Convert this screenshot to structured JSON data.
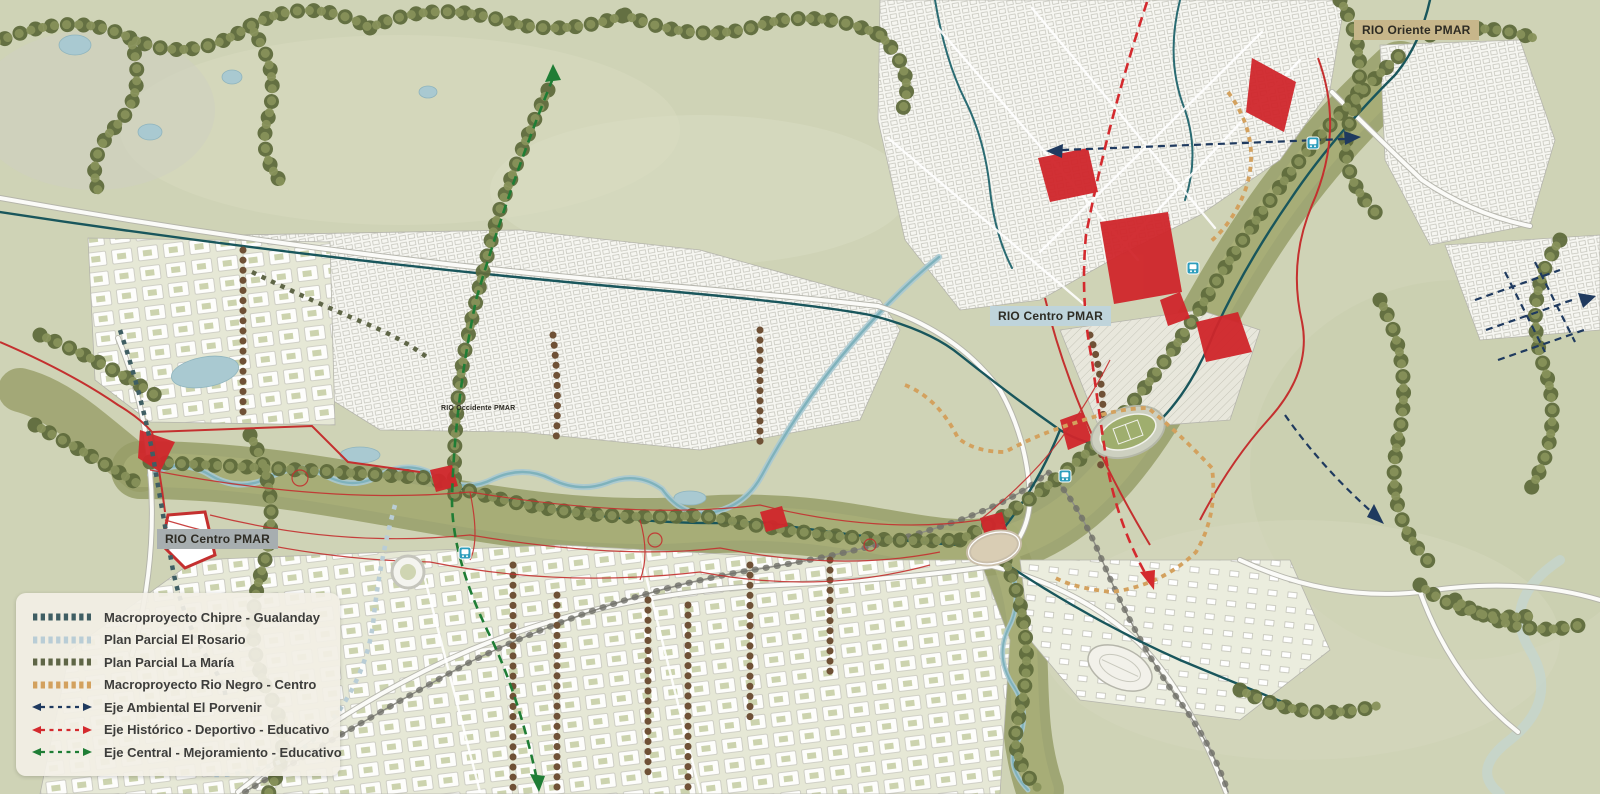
{
  "map": {
    "labels": [
      {
        "id": "rio-oriente",
        "text": "RIO Oriente PMAR",
        "bg": "#c7b68a"
      },
      {
        "id": "rio-centro-east",
        "text": "RIO Centro PMAR",
        "bg": "#bfd4db"
      },
      {
        "id": "rio-centro-west",
        "text": "RIO Centro PMAR",
        "bg": "#a7aeb0"
      },
      {
        "id": "rio-occidente",
        "text": "RIO Occidente PMAR",
        "bg": "transparent"
      }
    ],
    "station_icon": "bus-station",
    "colors": {
      "terrain": "#cfd3b6",
      "forest": "#64713f",
      "wetland": "#8f9560",
      "water": "#a9c9d1",
      "river_line": "#19565c",
      "urban": "#f6f6f1",
      "red_zone": "#d0262b",
      "rail": "#8d8d85",
      "station": "#2d9dbc"
    }
  },
  "legend": {
    "items": [
      {
        "label": "Macroproyecto Chipre - Gualanday",
        "color": "#3f5e63",
        "swatch": "dash-squares"
      },
      {
        "label": "Plan Parcial El Rosario",
        "color": "#b9cdd6",
        "swatch": "dash-squares"
      },
      {
        "label": "Plan Parcial La María",
        "color": "#5f6647",
        "swatch": "dash-squares"
      },
      {
        "label": "Macroproyecto Rio Negro - Centro",
        "color": "#d3a15e",
        "swatch": "dash-squares"
      },
      {
        "label": "Eje Ambiental El Porvenir",
        "color": "#1f3a5f",
        "swatch": "dash-arrows"
      },
      {
        "label": "Eje Histórico - Deportivo - Educativo",
        "color": "#d42a2e",
        "swatch": "dash-arrows"
      },
      {
        "label": "Eje Central - Mejoramiento - Educativo",
        "color": "#1f7d35",
        "swatch": "dash-arrows"
      }
    ]
  }
}
